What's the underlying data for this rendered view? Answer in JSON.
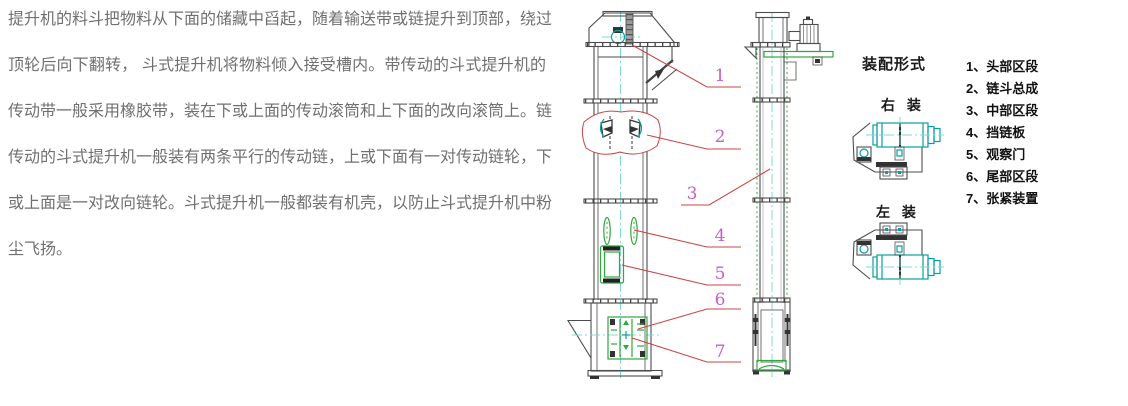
{
  "description": {
    "lines": [
      "提升机的料斗把物料从下面的储藏中舀起，随着输送带或链提升到顶部，绕过",
      "顶轮后向下翻转， 斗式提升机将物料倾入接受槽内。带传动的斗式提升机的",
      "传动带一般采用橡胶带，装在下或上面的传动滚筒和上下面的改向滚筒上。链",
      "传动的斗式提升机一般装有两条平行的传动链，上或下面有一对传动链轮，下",
      "或上面是一对改向链轮。斗式提升机一般都装有机壳，以防止斗式提升机中粉",
      "尘飞扬。"
    ]
  },
  "diagram": {
    "callouts": [
      "1",
      "2",
      "3",
      "4",
      "5",
      "6",
      "7"
    ]
  },
  "legend_panel": {
    "title": "装配形式",
    "mount_right": "右 装",
    "mount_left": "左 装",
    "items": [
      "1、头部区段",
      "2、链斗总成",
      "3、中部区段",
      "4、挡链板",
      "5、观察门",
      "6、尾部区段",
      "7、张紧装置"
    ]
  },
  "colors": {
    "background": "#ffffff",
    "body_text": "#707070",
    "drawing_outline": "#4d4d4d",
    "leader_red": "#cc4444",
    "callout_magenta": "#c75fc7",
    "pulley_teal": "#0a9f9f",
    "centerline_cyan": "#7fd8d8",
    "machine_green": "#2fa83c",
    "legend_text": "#111111"
  }
}
